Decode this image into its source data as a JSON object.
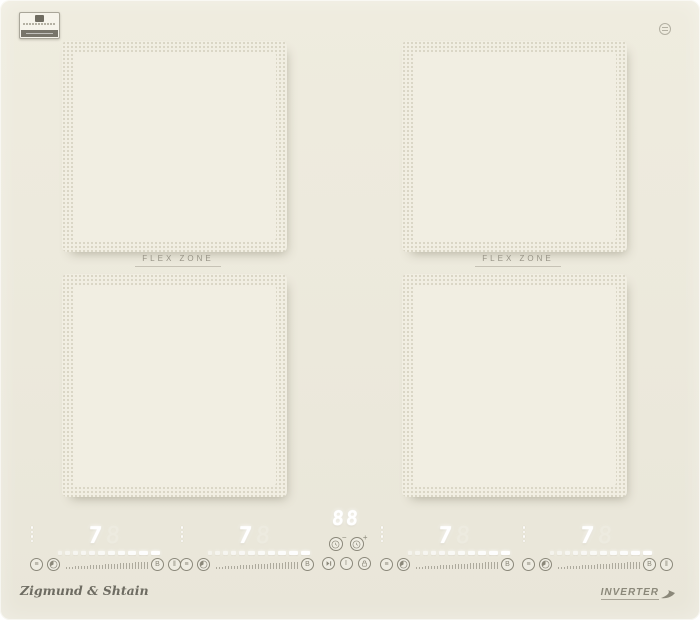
{
  "branding": {
    "logo_text": "Zigmund & Shtain",
    "inverter_text": "INVERTER"
  },
  "surface": {
    "background_color": "#ece9dc",
    "zone_fill_color": "#f1eee2",
    "zone_dot_color": "#d5d1c0",
    "icon_color": "#8b887a",
    "lit_segment_color": "#ffffff"
  },
  "zones": {
    "left": {
      "label": "FLEX ZONE"
    },
    "right": {
      "label": "FLEX ZONE"
    }
  },
  "controls": {
    "slider_segments": 11,
    "ramp_ticks": 28,
    "clusters": [
      {
        "level": "7",
        "ghost_digit": "8",
        "boost_label": "B"
      },
      {
        "level": "7",
        "ghost_digit": "8",
        "boost_label": "B"
      },
      {
        "level": "7",
        "ghost_digit": "8",
        "boost_label": "B"
      },
      {
        "level": "7",
        "ghost_digit": "8",
        "boost_label": "B"
      }
    ],
    "timer": {
      "display": "88",
      "minus_sign": "−",
      "plus_sign": "+"
    },
    "power_label": "I",
    "warm_glyph": "≡",
    "pause_glyph": "‖"
  }
}
